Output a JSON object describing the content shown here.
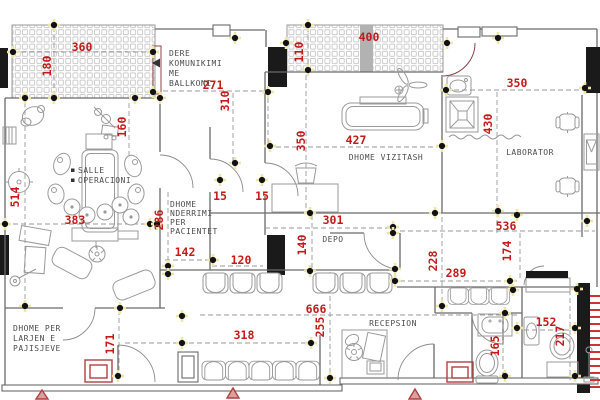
{
  "drawing_title": "clinic-floor-plan",
  "colors": {
    "dimension_red": "#c41a1a",
    "wall_gray": "#6a6a6a",
    "furniture_gray": "#9a9a9a",
    "door_maroon": "#8a4444",
    "marker_red": "#b04040",
    "node_black": "#111111",
    "node_highlight": "#f0e6a8"
  },
  "labels": {
    "dere": [
      "DERE",
      "KOMUNIKIMI",
      "ME",
      "BALLKONI"
    ],
    "salle": [
      "SALLE",
      "OPERACIONI"
    ],
    "nderrimi": [
      "DHOME",
      "NDERRIMI",
      "PER",
      "PACIENTET"
    ],
    "vizitash": "DHOME VIZITASH",
    "laborator": "LABORATOR",
    "depo": "DEPO",
    "recepsion": "RECEPSION",
    "larjen": [
      "DHOME PER",
      "LARJEN E",
      "PAJISJEVE"
    ]
  },
  "dims": {
    "v360": "360",
    "v180": "180",
    "v160": "160",
    "v271": "271",
    "v310": "310",
    "v110": "110",
    "v400": "400",
    "v350_lab": "350",
    "v430": "430",
    "v514": "514",
    "v383": "383",
    "v286": "286",
    "v142": "142",
    "v120": "120",
    "v15_a": "15",
    "v15_b": "15",
    "v350_viz": "350",
    "v427": "427",
    "v301": "301",
    "v140": "140",
    "v536": "536",
    "v174": "174",
    "v228": "228",
    "v289": "289",
    "v666": "666",
    "v255": "255",
    "v318": "318",
    "v171": "171",
    "v152": "152",
    "v217": "217",
    "v165": "165"
  }
}
